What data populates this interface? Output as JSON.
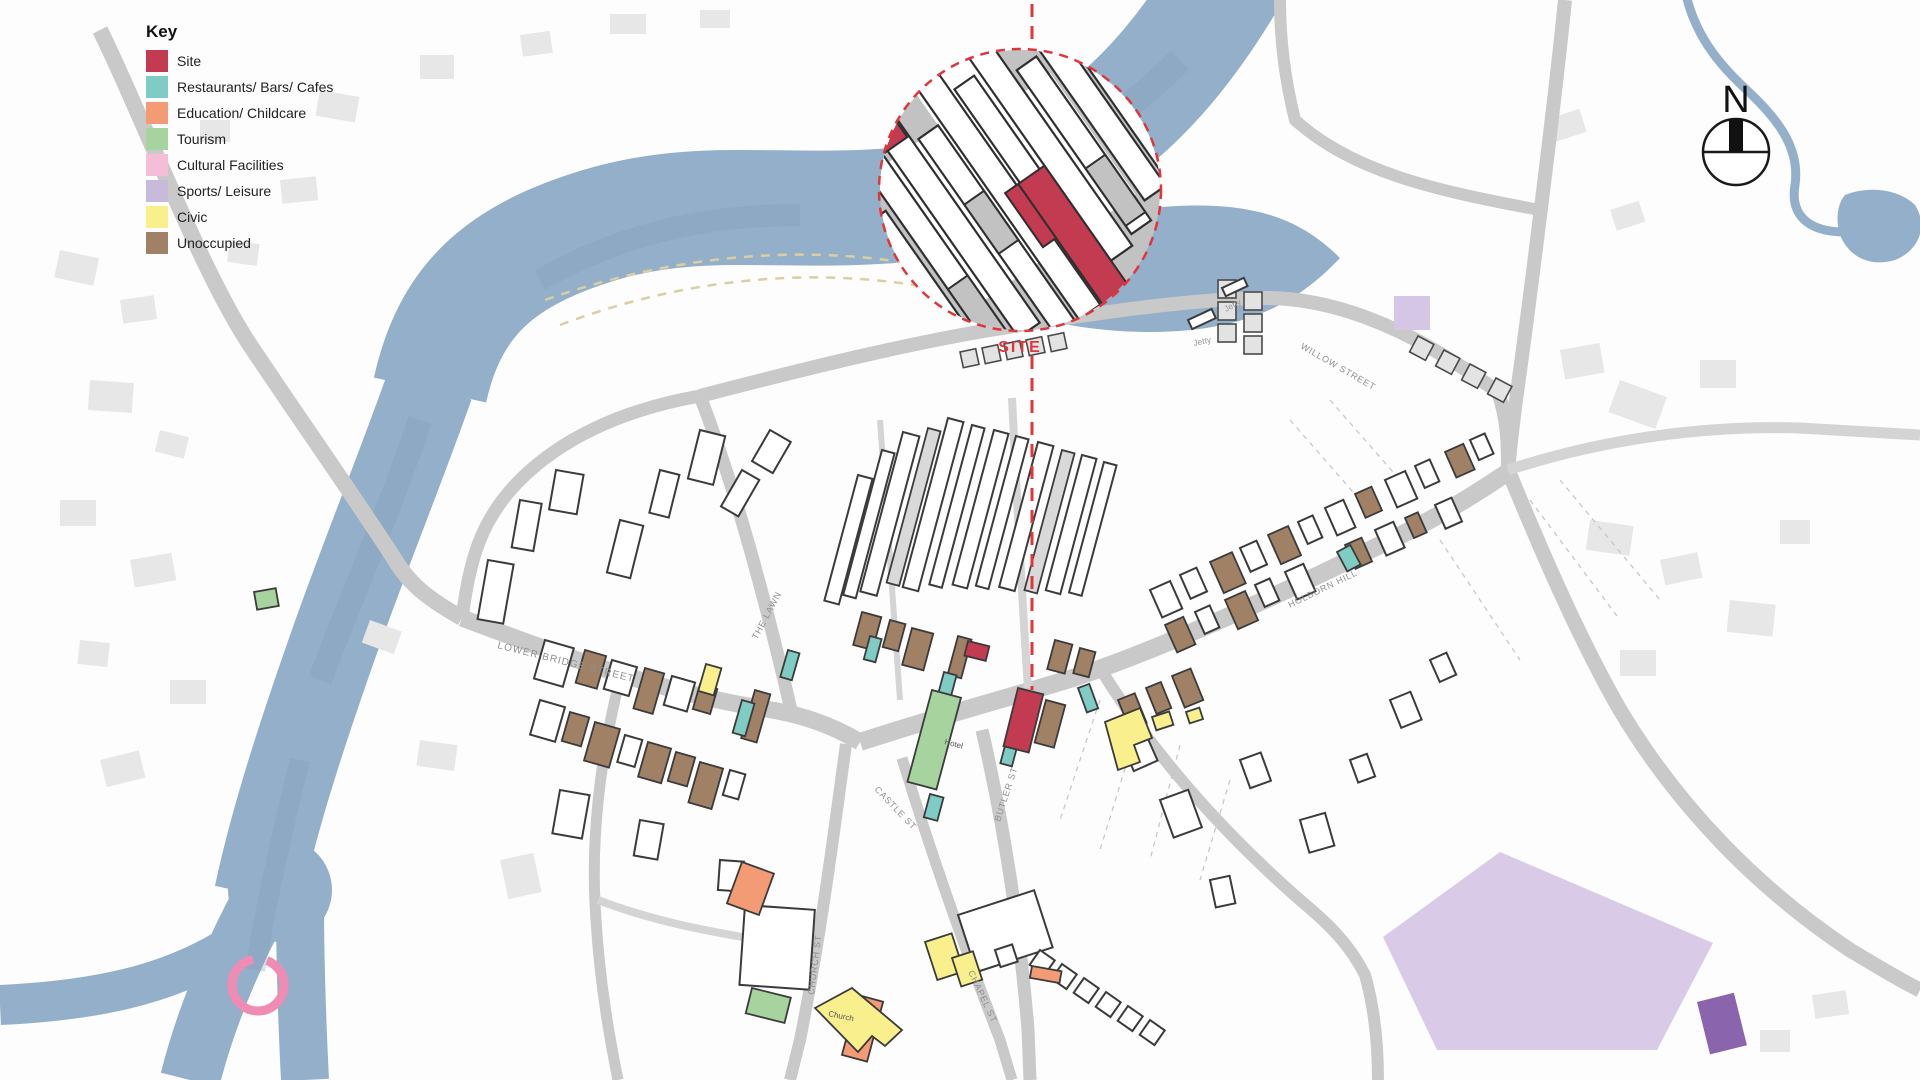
{
  "legend": {
    "title": "Key",
    "items": [
      {
        "label": "Site",
        "color": "#c23b50"
      },
      {
        "label": "Restaurants/ Bars/ Cafes",
        "color": "#7fccc5"
      },
      {
        "label": "Education/ Childcare",
        "color": "#f39b74"
      },
      {
        "label": "Tourism",
        "color": "#a6d39e"
      },
      {
        "label": "Cultural Facilities",
        "color": "#f4bdd8"
      },
      {
        "label": "Sports/ Leisure",
        "color": "#c7badb"
      },
      {
        "label": "Civic",
        "color": "#f9f08d"
      },
      {
        "label": "Unoccupied",
        "color": "#a08165"
      }
    ]
  },
  "inset": {
    "site_label": "SITE",
    "accent_color": "#e0353a"
  },
  "compass": {
    "label": "N"
  },
  "map": {
    "street_labels": [
      {
        "label": "LOWER BRIDGE STREET"
      },
      {
        "label": "THE LAWN"
      },
      {
        "label": "CASTLE ST"
      },
      {
        "label": "BUTLER ST"
      },
      {
        "label": "CHURCH ST"
      },
      {
        "label": "CHAPEL ST"
      },
      {
        "label": "HOLBORN HILL"
      },
      {
        "label": "WILLOW STREET"
      }
    ],
    "jetty_labels": [
      "Jetty",
      "Jetty"
    ],
    "building_labels": {
      "hotel": "Hotel",
      "church": "Church"
    },
    "colors": {
      "river": "#94afc9",
      "road": "#c9c9c9",
      "background_building": "#e7e7e7",
      "building_outline": "#3b3b3b",
      "site_line": "#e0353a",
      "sports_field": "#d9cbe7",
      "purple_building": "#8b64ae"
    }
  }
}
